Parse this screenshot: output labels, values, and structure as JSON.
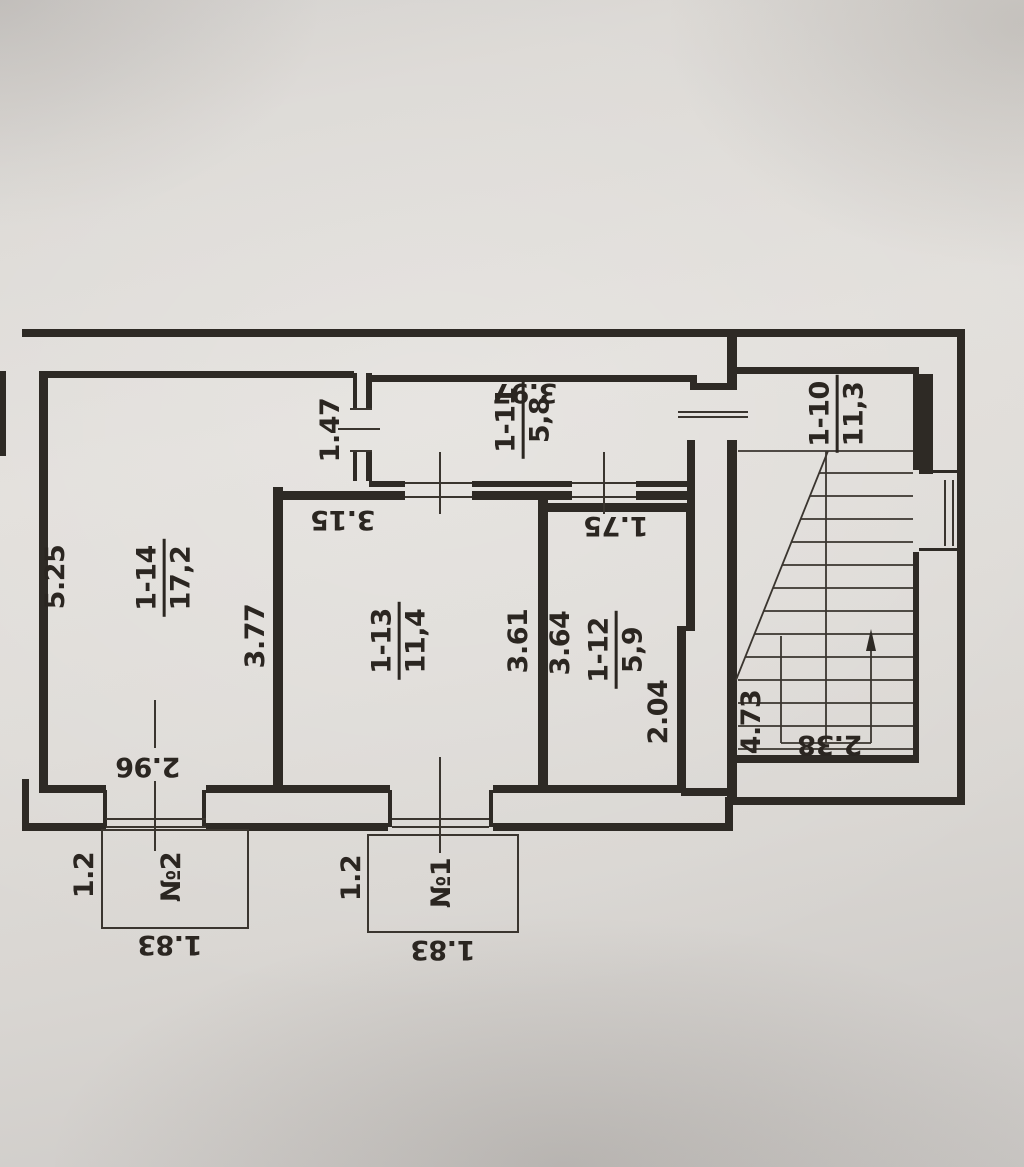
{
  "document": {
    "kind": "floor-plan-photo",
    "colors": {
      "paper": "#dedbd7",
      "ink": "#2e2a25",
      "text": "#2b2621"
    }
  },
  "rooms": [
    {
      "number": "1-14",
      "area": "17,2"
    },
    {
      "number": "1-13",
      "area": "11,4"
    },
    {
      "number": "1-12",
      "area": "5,9"
    },
    {
      "number": "1-11",
      "area": "5,8"
    },
    {
      "number": "1-10",
      "area": "11,3"
    }
  ],
  "dims": [
    {
      "text": "5.25"
    },
    {
      "text": "3.77"
    },
    {
      "text": "1.47"
    },
    {
      "text": "3.61"
    },
    {
      "text": "3.64"
    },
    {
      "text": "2.04"
    },
    {
      "text": "4.73"
    },
    {
      "text": "1.2"
    },
    {
      "text": "1.2"
    },
    {
      "text": "2.96"
    },
    {
      "text": "3.15"
    },
    {
      "text": "3.97"
    },
    {
      "text": "1.75"
    },
    {
      "text": "2.38"
    },
    {
      "text": "1.83"
    },
    {
      "text": "1.83"
    }
  ],
  "balconies": [
    {
      "label": "№2"
    },
    {
      "label": "№1"
    }
  ]
}
